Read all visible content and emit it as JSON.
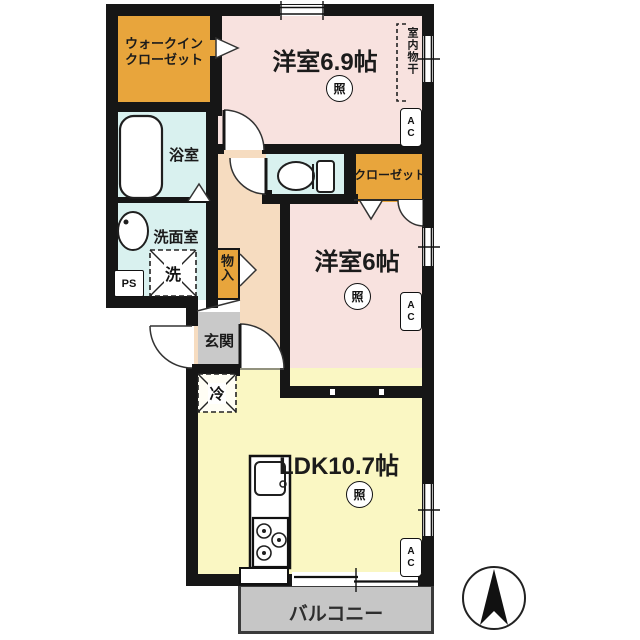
{
  "rooms": {
    "wic_line1": "ウォークイン",
    "wic_line2": "クローゼット",
    "bedroom1": "洋室6.9帖",
    "bedroom2": "洋室6帖",
    "ldk": "LDK10.7帖",
    "bath": "浴室",
    "washroom": "洗面室",
    "closet": "クローゼット",
    "storage": "物入",
    "entrance": "玄関",
    "balcony": "バルコニー"
  },
  "fixtures": {
    "washer": "洗",
    "fridge": "冷",
    "pipe_space": "PS",
    "light": "照",
    "ac": "AC",
    "indoor_drying": "室内物干"
  },
  "colors": {
    "bedroom_pink": "#F8E2DF",
    "ldk_yellow": "#FAF7C3",
    "closet_orange": "#E8A53C",
    "wet_cyan": "#D9F1EF",
    "hall_peach": "#F6DCC0",
    "entrance_gray": "#C9C9C9",
    "balcony_gray": "#C6C6C6",
    "wall_black": "#161616"
  }
}
